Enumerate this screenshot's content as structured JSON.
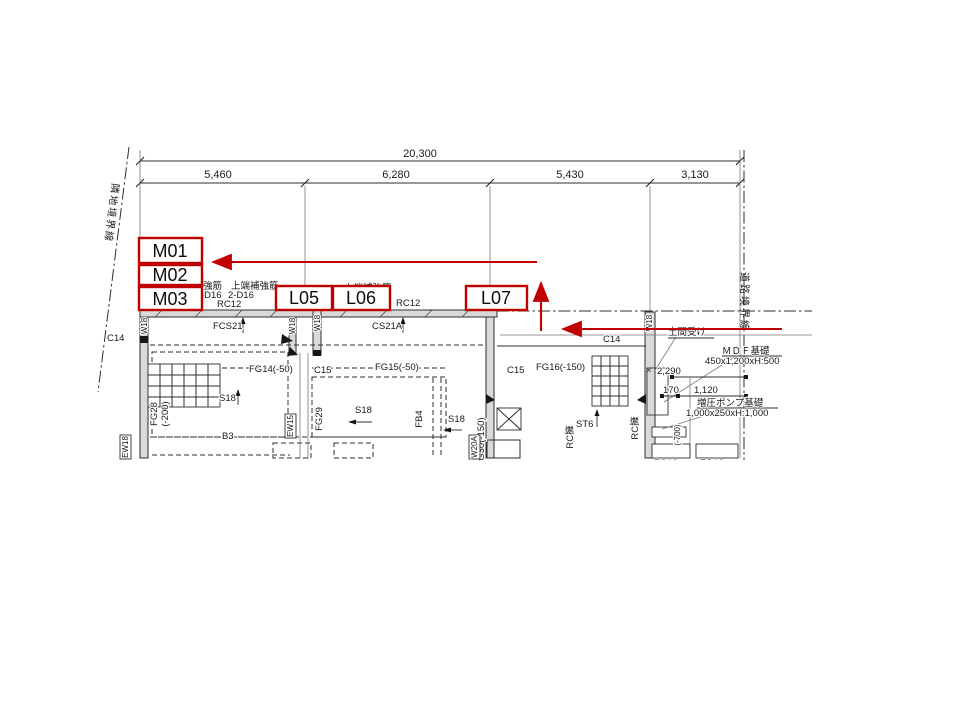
{
  "colors": {
    "annotation_red": "#c00000",
    "line_dark": "#2e2e2e"
  },
  "dimensions": {
    "total": "20,300",
    "seg1": "5,460",
    "seg2": "6,280",
    "seg3": "5,430",
    "seg4": "3,130"
  },
  "boundaries": {
    "left": "隣地境界線",
    "right": "道路境界線"
  },
  "callouts": {
    "m01": "M01",
    "m02": "M02",
    "m03": "M03",
    "l05": "L05",
    "l06": "L06",
    "l07": "L07"
  },
  "labels": {
    "rebar_lower": "強筋",
    "rebar_lower_val": "-D16",
    "rebar_upper": "上端補強筋",
    "rebar_upper_val": "2-D16",
    "rebar_upper2": "上端補強筋",
    "rc12_a": "RC12",
    "rc12_b": "RC12",
    "fcs21": "FCS21",
    "cs21a": "CS21A",
    "c14_left": "C14",
    "c14_mid": "C14",
    "c15_a": "C15",
    "c15_b": "C15",
    "fg14": "FG14(-50)",
    "fg15": "FG15(-50)",
    "fg16": "FG16(-150)",
    "fg28": "FG28",
    "fg28_depth": "(-200)",
    "fg29": "FG29",
    "fg30": "FG30(-150)",
    "s18_a": "S18",
    "s18_b": "S18",
    "s18_c": "S18",
    "st6": "ST6",
    "b3": "B3",
    "fb4": "FB4",
    "ew18": "EW18",
    "ew15": "EW15",
    "w18_a": "W18",
    "w18_b": "W18",
    "w18_c": "W18",
    "w18_d": "W18",
    "w20a": "W20A",
    "rc_wall_a": "RC擁",
    "rc_wall_b": "RC擁",
    "doma_uke": "土間受け",
    "mdf_title": "ＭＤＦ基礎",
    "mdf_size": "450x1,200xH:500",
    "pump_title": "増圧ポンプ基礎",
    "pump_size": "1,000x250xH:1,000",
    "dim_2290": "2,290",
    "dim_170": "170",
    "dim_1120": "1,120",
    "depth_700": "(-700)",
    "fg13_a": "FG13",
    "fg13_b": "FG13"
  }
}
